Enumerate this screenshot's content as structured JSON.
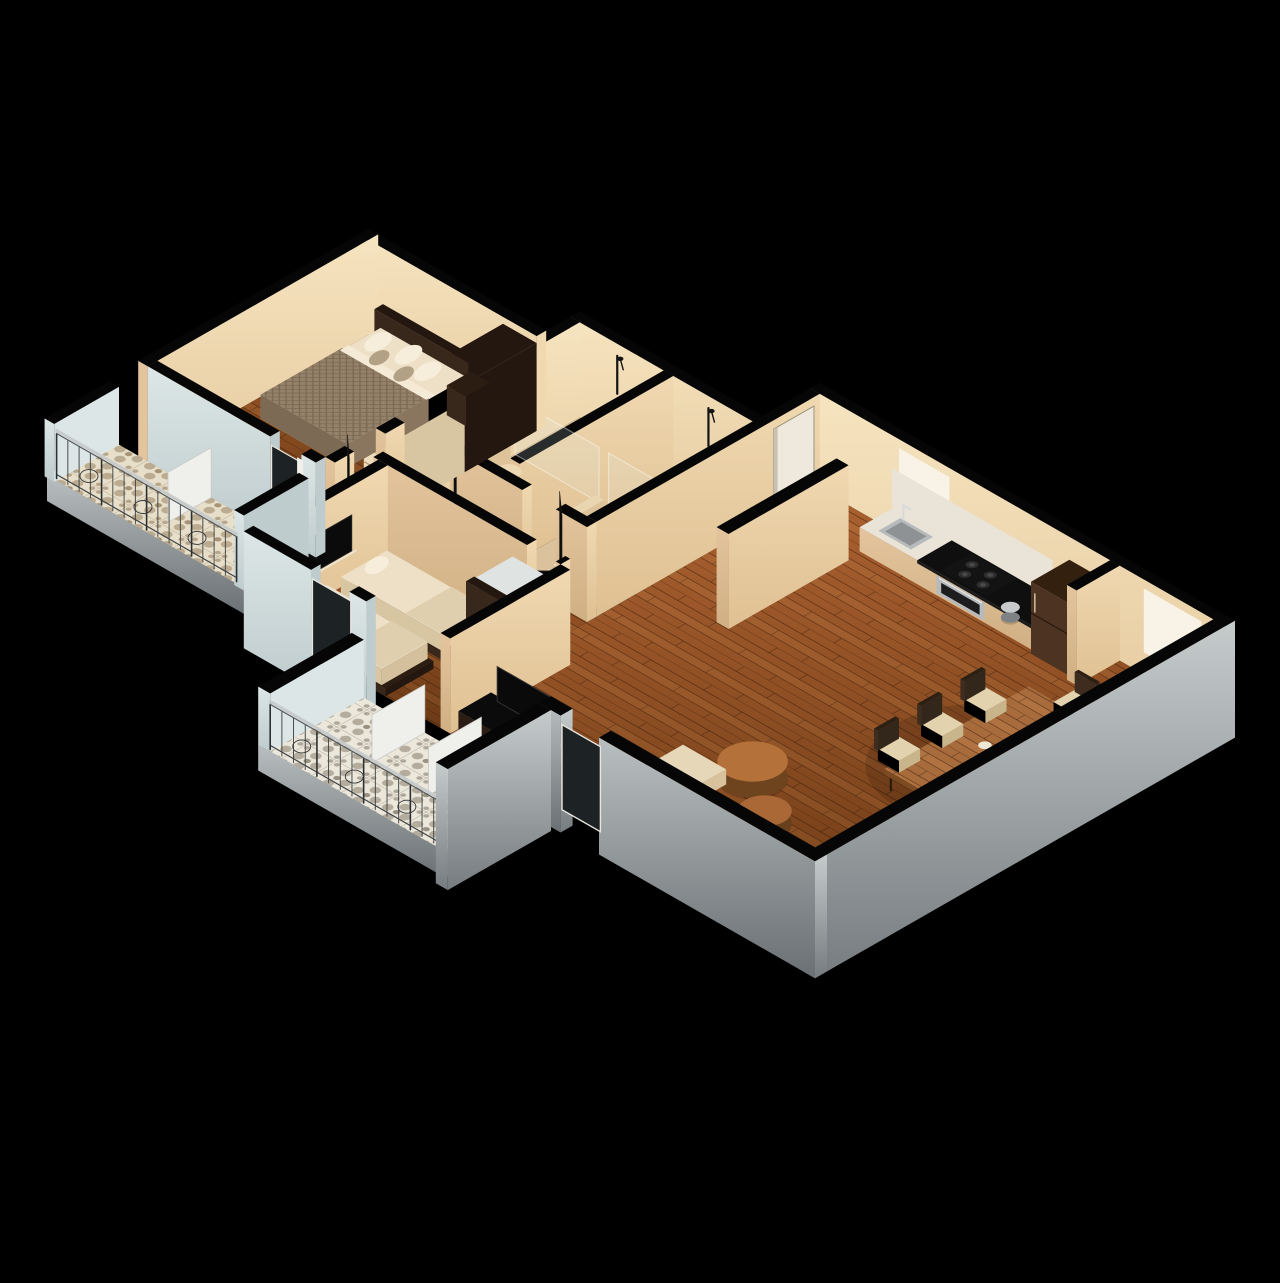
{
  "canvas": {
    "width": 1280,
    "height": 1283,
    "background": "#000000"
  },
  "palette": {
    "bg": "#000000",
    "wall_cap": "#060606",
    "cream_south": "#e3c49c",
    "cream_south_dark": "#d0af83",
    "cream_east": "#f0d8b0",
    "cream_east_dark": "#dfc092",
    "cream_bright": "#f6e4c0",
    "bath_floor": "#dcc29c",
    "bath_floor_shower": "#cfb28a",
    "wood_light": "#ab6130",
    "wood_mid": "#8f4f23",
    "wood_dark": "#6d3a15",
    "plank_line": "rgba(45,19,5,0.5)",
    "gray_top": "#c6cbcc",
    "gray_bottom": "#767c7f",
    "blue_wall": "#dce6e6",
    "blue_wall_shade": "#bfcccd",
    "tile_base_warm": "#e7dfca",
    "tile_motif_warm": "#977f60",
    "tile_base_cool": "#ebe7db",
    "tile_motif_cool": "#867c6a",
    "espresso": "#38281c",
    "espresso_dark": "#241710",
    "walnut": "#4d3322",
    "walnut_dark": "#33200f",
    "shelf_cream": "#ecdcbc",
    "shelf_line": "#b49a74",
    "mattress": "#eee0c6",
    "mattress_side": "#d8c5a2",
    "blanket": "#96826a",
    "blanket_side": "#7c6a54",
    "pillow_white": "#f6eeda",
    "pillow_taupe": "#b3a186",
    "sofa": "#e7d7b9",
    "sofa_side": "#cfb894",
    "table_wood": "#a86b3c",
    "table_side": "#7c4b21",
    "chair_frame": "#3e2d1f",
    "chair_seat": "#e3d2ae",
    "counter_black": "#0f0f0f",
    "marble": "#eae3d7",
    "steel": "#b7babb",
    "steel_dark": "#8e9294",
    "glass_dark": "#1d2224",
    "white_door": "#efe9dd",
    "railing_dark": "#2d3032",
    "railing_light": "#c7cbcc",
    "glass_pane": "rgba(224,240,240,0.16)",
    "glass_edge": "rgba(255,255,255,0.42)",
    "window_glow": "#f8f3e6",
    "shadow": "rgba(0,0,0,0.3)"
  },
  "scene": {
    "type": "isometric-apartment-floor-plan",
    "rooms": [
      {
        "id": "master-bedroom"
      },
      {
        "id": "bedroom-2"
      },
      {
        "id": "bathroom-1"
      },
      {
        "id": "bathroom-2"
      },
      {
        "id": "corridor"
      },
      {
        "id": "entry"
      },
      {
        "id": "kitchen"
      },
      {
        "id": "dining-area"
      },
      {
        "id": "living-area"
      },
      {
        "id": "balcony-1"
      },
      {
        "id": "balcony-2"
      }
    ],
    "furniture": [
      {
        "id": "double-bed"
      },
      {
        "id": "bed-headboard"
      },
      {
        "id": "bedside-cabinet"
      },
      {
        "id": "master-wardrobe"
      },
      {
        "id": "master-shelving"
      },
      {
        "id": "twin-bed-a"
      },
      {
        "id": "twin-bed-b"
      },
      {
        "id": "bedroom2-shelving"
      },
      {
        "id": "bedroom2-tv"
      },
      {
        "id": "tv-console"
      },
      {
        "id": "living-tv"
      },
      {
        "id": "sofa"
      },
      {
        "id": "coffee-table-large"
      },
      {
        "id": "coffee-table-small"
      },
      {
        "id": "dining-table"
      },
      {
        "id": "dining-chair"
      },
      {
        "id": "table-vases"
      }
    ],
    "fixtures": [
      {
        "id": "kitchen-counter"
      },
      {
        "id": "kitchen-sink"
      },
      {
        "id": "cooktop"
      },
      {
        "id": "oven"
      },
      {
        "id": "refrigerator"
      },
      {
        "id": "toilet"
      },
      {
        "id": "vanity"
      },
      {
        "id": "shower"
      },
      {
        "id": "shower-glass"
      },
      {
        "id": "entry-door"
      },
      {
        "id": "interior-door"
      },
      {
        "id": "balcony-railing"
      },
      {
        "id": "balcony-tiles"
      },
      {
        "id": "window"
      }
    ]
  }
}
